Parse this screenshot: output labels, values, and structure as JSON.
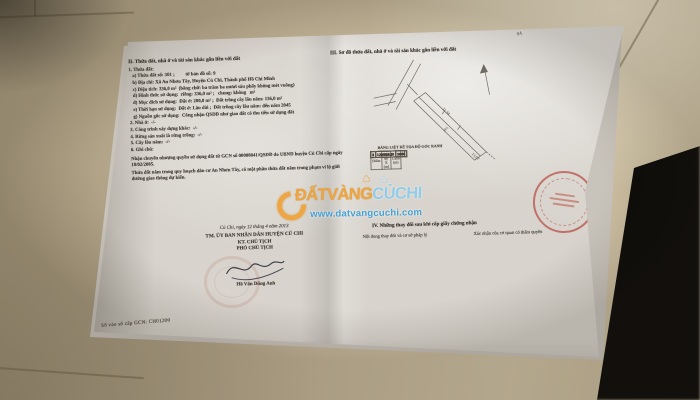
{
  "colors": {
    "floor": "#bfb296",
    "paper": "#d8d4cd",
    "ink": "#45403a",
    "wm-orange": "#eea43c",
    "wm-blue": "#8ecbe9",
    "wm-url": "#3d9ed6",
    "stamp-red": "#b23a30"
  },
  "left_page": {
    "title": "II. Thửa đất, nhà ở và tài sản khác gắn liền với đất",
    "lines": [
      "1. Thửa đất:",
      "   a) Thửa đất số: 301 ;         tờ bản đồ số: 9",
      "   b) Địa chỉ: Xã An Nhơn Tây, Huyện Củ Chi, Thành phố Hồ Chí Minh",
      "   c) Diện tích: 336,0 m²  (bằng chữ: ba trăm ba mươi sáu phẩy không mét vuông)",
      "   d) Hình thức sử dụng:  riêng: 336,0 m² ;   chung: không   m²",
      "   đ) Mục đích sử dụng:  Đất ở: 200,0 m² ;  Đất trồng cây lâu năm: 136,0 m²",
      "   e) Thời hạn sử dụng:  Đất ở: Lâu dài ;  Đất trồng cây lâu năm: đến năm 2045",
      "   g) Nguồn gốc sử dụng:  Công nhận QSDĐ như giao đất có thu tiền sử dụng đất",
      "2. Nhà ở:  -/-",
      "3. Công trình xây dựng khác:  -/-",
      "4. Rừng sản xuất là rừng trồng:  -/-",
      "5. Cây lâu năm:  -/-",
      "6. Ghi chú:"
    ],
    "notes": [
      "Nhận chuyển nhượng quyền sử dụng đất từ GCN số 00000841/QSDĐ do UBND huyện Củ Chi cấp ngày 18/02/2005.",
      "Thửa đất nằm trong quy hoạch dân cư An Nhơn Tây, có một phần thửa đất nằm trong phạm vi lộ giới đường giao thông dự kiến."
    ],
    "sign": {
      "place_date": "Củ Chi, ngày 12 tháng 4 năm 2013",
      "committee": "TM. ỦY BAN NHÂN DÂN HUYỆN CỦ CHI",
      "kt": "KT. CHỦ TỊCH",
      "deputy": "PHÓ CHỦ TỊCH",
      "signer": "Hồ Văn Dũng Anh"
    },
    "book_no": "Số vào sổ cấp GCN:  CH01200"
  },
  "right_page": {
    "title": "III. Sơ đồ thửa đất, nhà ở và tài sản khác gắn liền với đất",
    "corner_mark": "04",
    "map": {
      "parcel_no": "301",
      "edge_top": "31.94",
      "edge_end": "13.07"
    },
    "coord_table": {
      "title": "BẢNG LIỆT KÊ TỌA ĐỘ GÓC RANH",
      "headers": {
        "point": "Điểm",
        "coord": "Tọa độ X (m)",
        "edge": "Cạnh (m)"
      },
      "rows": [
        {
          "p": "1",
          "x": "1209017.53",
          "c": "13.07"
        },
        {
          "p": "2",
          "x": "1209009.18",
          "c": "7.26"
        },
        {
          "p": "3",
          "x": "1209004.75",
          "c": "31.94"
        },
        {
          "p": "4",
          "x": "1208984.63",
          "c": "13.06"
        },
        {
          "p": "5",
          "x": "1208976.40",
          "c": "7.48"
        },
        {
          "p": "6",
          "x": "1208989.85",
          "c": "30.61"
        }
      ]
    },
    "section4_title": "IV. Những thay đổi sau khi cấp giấy chứng nhận",
    "col_left": "Nội dung thay đổi và cơ sở pháp lý",
    "col_right": "Xác nhận của cơ quan có thẩm quyền"
  },
  "watermark": {
    "brand_orange": "ĐẤTVÀNG",
    "brand_blue": "CỦCHI",
    "url": "www.datvangcuchi.com",
    "house_glyph": "⌂"
  }
}
